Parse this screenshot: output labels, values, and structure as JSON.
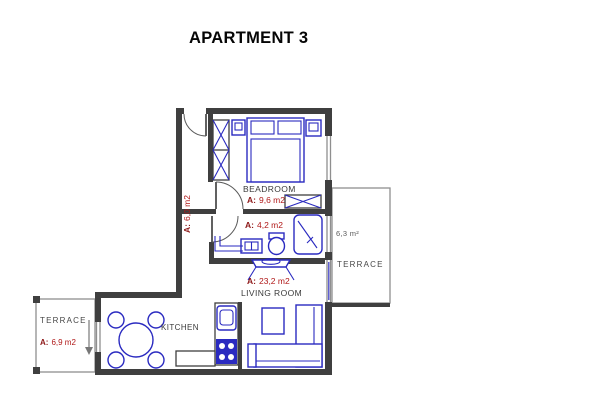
{
  "title": "APARTMENT 3",
  "rooms": {
    "bedroom": {
      "name": "BEADROOM",
      "area_prefix": "A:",
      "area_value": "9,6 m2"
    },
    "hallway": {
      "area_prefix": "A:",
      "area_value": "6,0 m2"
    },
    "bathroom": {
      "area_prefix": "A:",
      "area_value": "4,2 m2"
    },
    "living_room": {
      "name": "LIVING ROOM",
      "area_prefix": "A:",
      "area_value": "23,2 m2"
    },
    "kitchen": {
      "name": "KITCHEN"
    },
    "terrace_left": {
      "name": "TERRACE",
      "area_prefix": "A:",
      "area_value": "6,9 m2"
    },
    "terrace_right": {
      "name": "TERRACE",
      "area_value": "6,3 m²"
    }
  },
  "colors": {
    "wall": "#3f3f3f",
    "furniture": "#2a2ac0",
    "area_label": "#b01818",
    "room_label": "#3a3a3a"
  }
}
